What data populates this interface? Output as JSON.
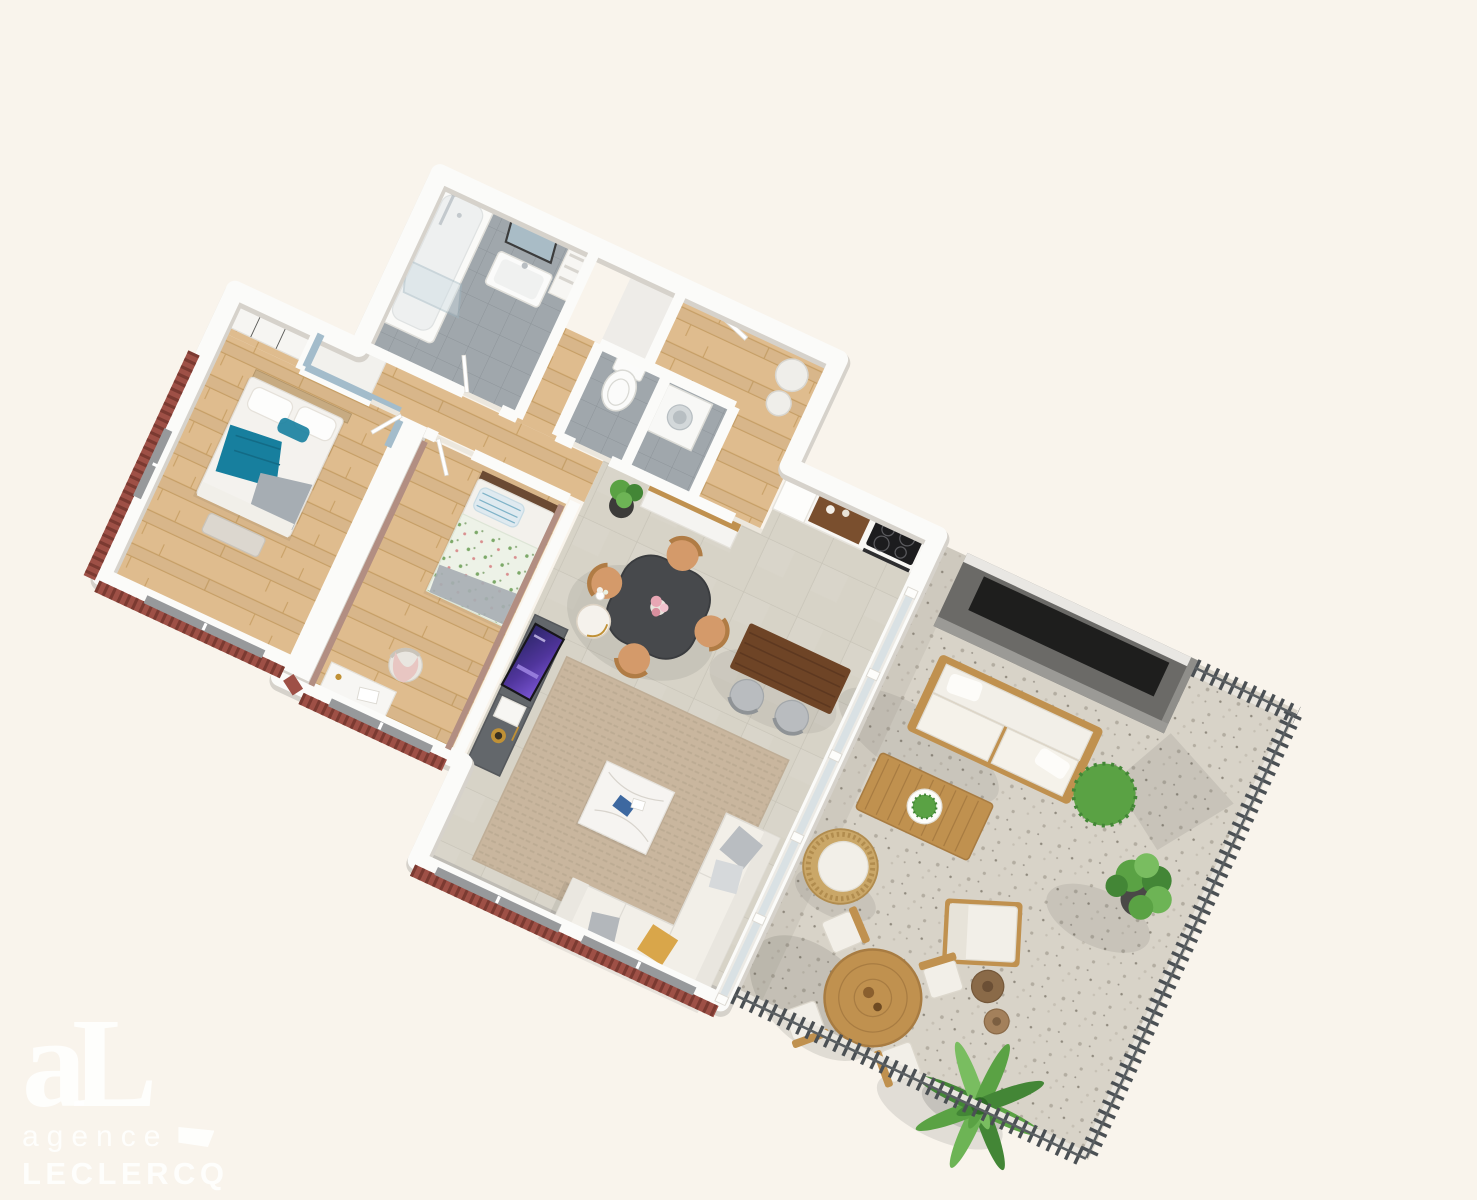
{
  "watermark": {
    "monogram": "aL",
    "line1": "agence",
    "line2": "LECLERCQ"
  },
  "palette": {
    "bg": "#f9f4ec",
    "wall": "#fbfbf9",
    "wallShade": "#d6d2cb",
    "wood": "#dfbc8e",
    "woodLine": "#c9a167",
    "tile": "#d7d3c7",
    "tileLine": "#c7c3b7",
    "bath": "#a0a7ac",
    "bathLine": "#8d9499",
    "terrace": "#d8d3c8",
    "speck1": "#b3ada1",
    "speck2": "#c6c0b4",
    "blue": "#a3bccb",
    "mauve": "#b28e82",
    "brick": "#9e5046",
    "brickDark": "#7b3a31",
    "teal": "#177f9e",
    "grayBlanket": "#a6adb3",
    "rug": "#c9b69e",
    "rugLine": "#bcab93",
    "tvUnit": "#63676b",
    "marble": "#f6f4f1",
    "walnut": "#6e4426",
    "tableTop": "#47494c",
    "tan": "#d49a6a",
    "tanDark": "#b07c45",
    "outWood": "#c0914f",
    "outWoodDark": "#a87c42",
    "cushion": "#f2efe8",
    "planter": "#6b6a67",
    "planterInner": "#1e1e1d",
    "green": "#5aa244",
    "greenDark": "#438636",
    "gold": "#c09136",
    "glass": "#cfdde4",
    "rail": "#4b5054",
    "pink": "#e8c6c2",
    "window": "#97999b",
    "shadow": "#3a3a38"
  },
  "scene": {
    "type": "3d-floor-plan-render",
    "rooms": [
      {
        "id": "master-bedroom",
        "floor": "wood",
        "features": [
          "wardrobe",
          "double-bed",
          "teal-and-gray-bedding",
          "blue-accent-wall",
          "bench"
        ]
      },
      {
        "id": "bedroom-2",
        "floor": "wood",
        "features": [
          "single-bed",
          "floral-bedding",
          "desk",
          "chair-with-pink-throw",
          "mauve-accent-walls"
        ]
      },
      {
        "id": "bathroom",
        "floor": "gray-tile",
        "features": [
          "bathtub",
          "glass-shower-screen",
          "mirror",
          "wall-hung-sink"
        ]
      },
      {
        "id": "wc",
        "floor": "gray-tile",
        "features": [
          "toilet"
        ]
      },
      {
        "id": "laundry-nook",
        "floor": "gray-tile",
        "features": [
          "washing-machine"
        ]
      },
      {
        "id": "hallway",
        "floor": "wood",
        "features": [
          "doors"
        ]
      },
      {
        "id": "entry-hall",
        "floor": "wood",
        "features": [
          "water-heater"
        ]
      },
      {
        "id": "kitchen",
        "floor": "large-tile",
        "features": [
          "white-cabinets",
          "wood-niche",
          "induction-hob",
          "oven"
        ]
      },
      {
        "id": "living-dining-room",
        "floor": "large-tile",
        "features": [
          "dining-table",
          "four-chairs",
          "sideboard",
          "plant",
          "bar-table",
          "two-stools",
          "tv-sideboard",
          "flat-tv",
          "floor-lamp",
          "rug",
          "marble-coffee-table",
          "corner-sofa"
        ]
      },
      {
        "id": "terrace",
        "floor": "gravel",
        "features": [
          "planter-wall",
          "outdoor-sofa",
          "coffee-table",
          "wicker-chair",
          "lounge-chair",
          "side-tables",
          "round-dining-table",
          "four-chairs",
          "boxwood",
          "plants",
          "palm",
          "slat-railing",
          "glass-balustrade"
        ]
      }
    ]
  }
}
